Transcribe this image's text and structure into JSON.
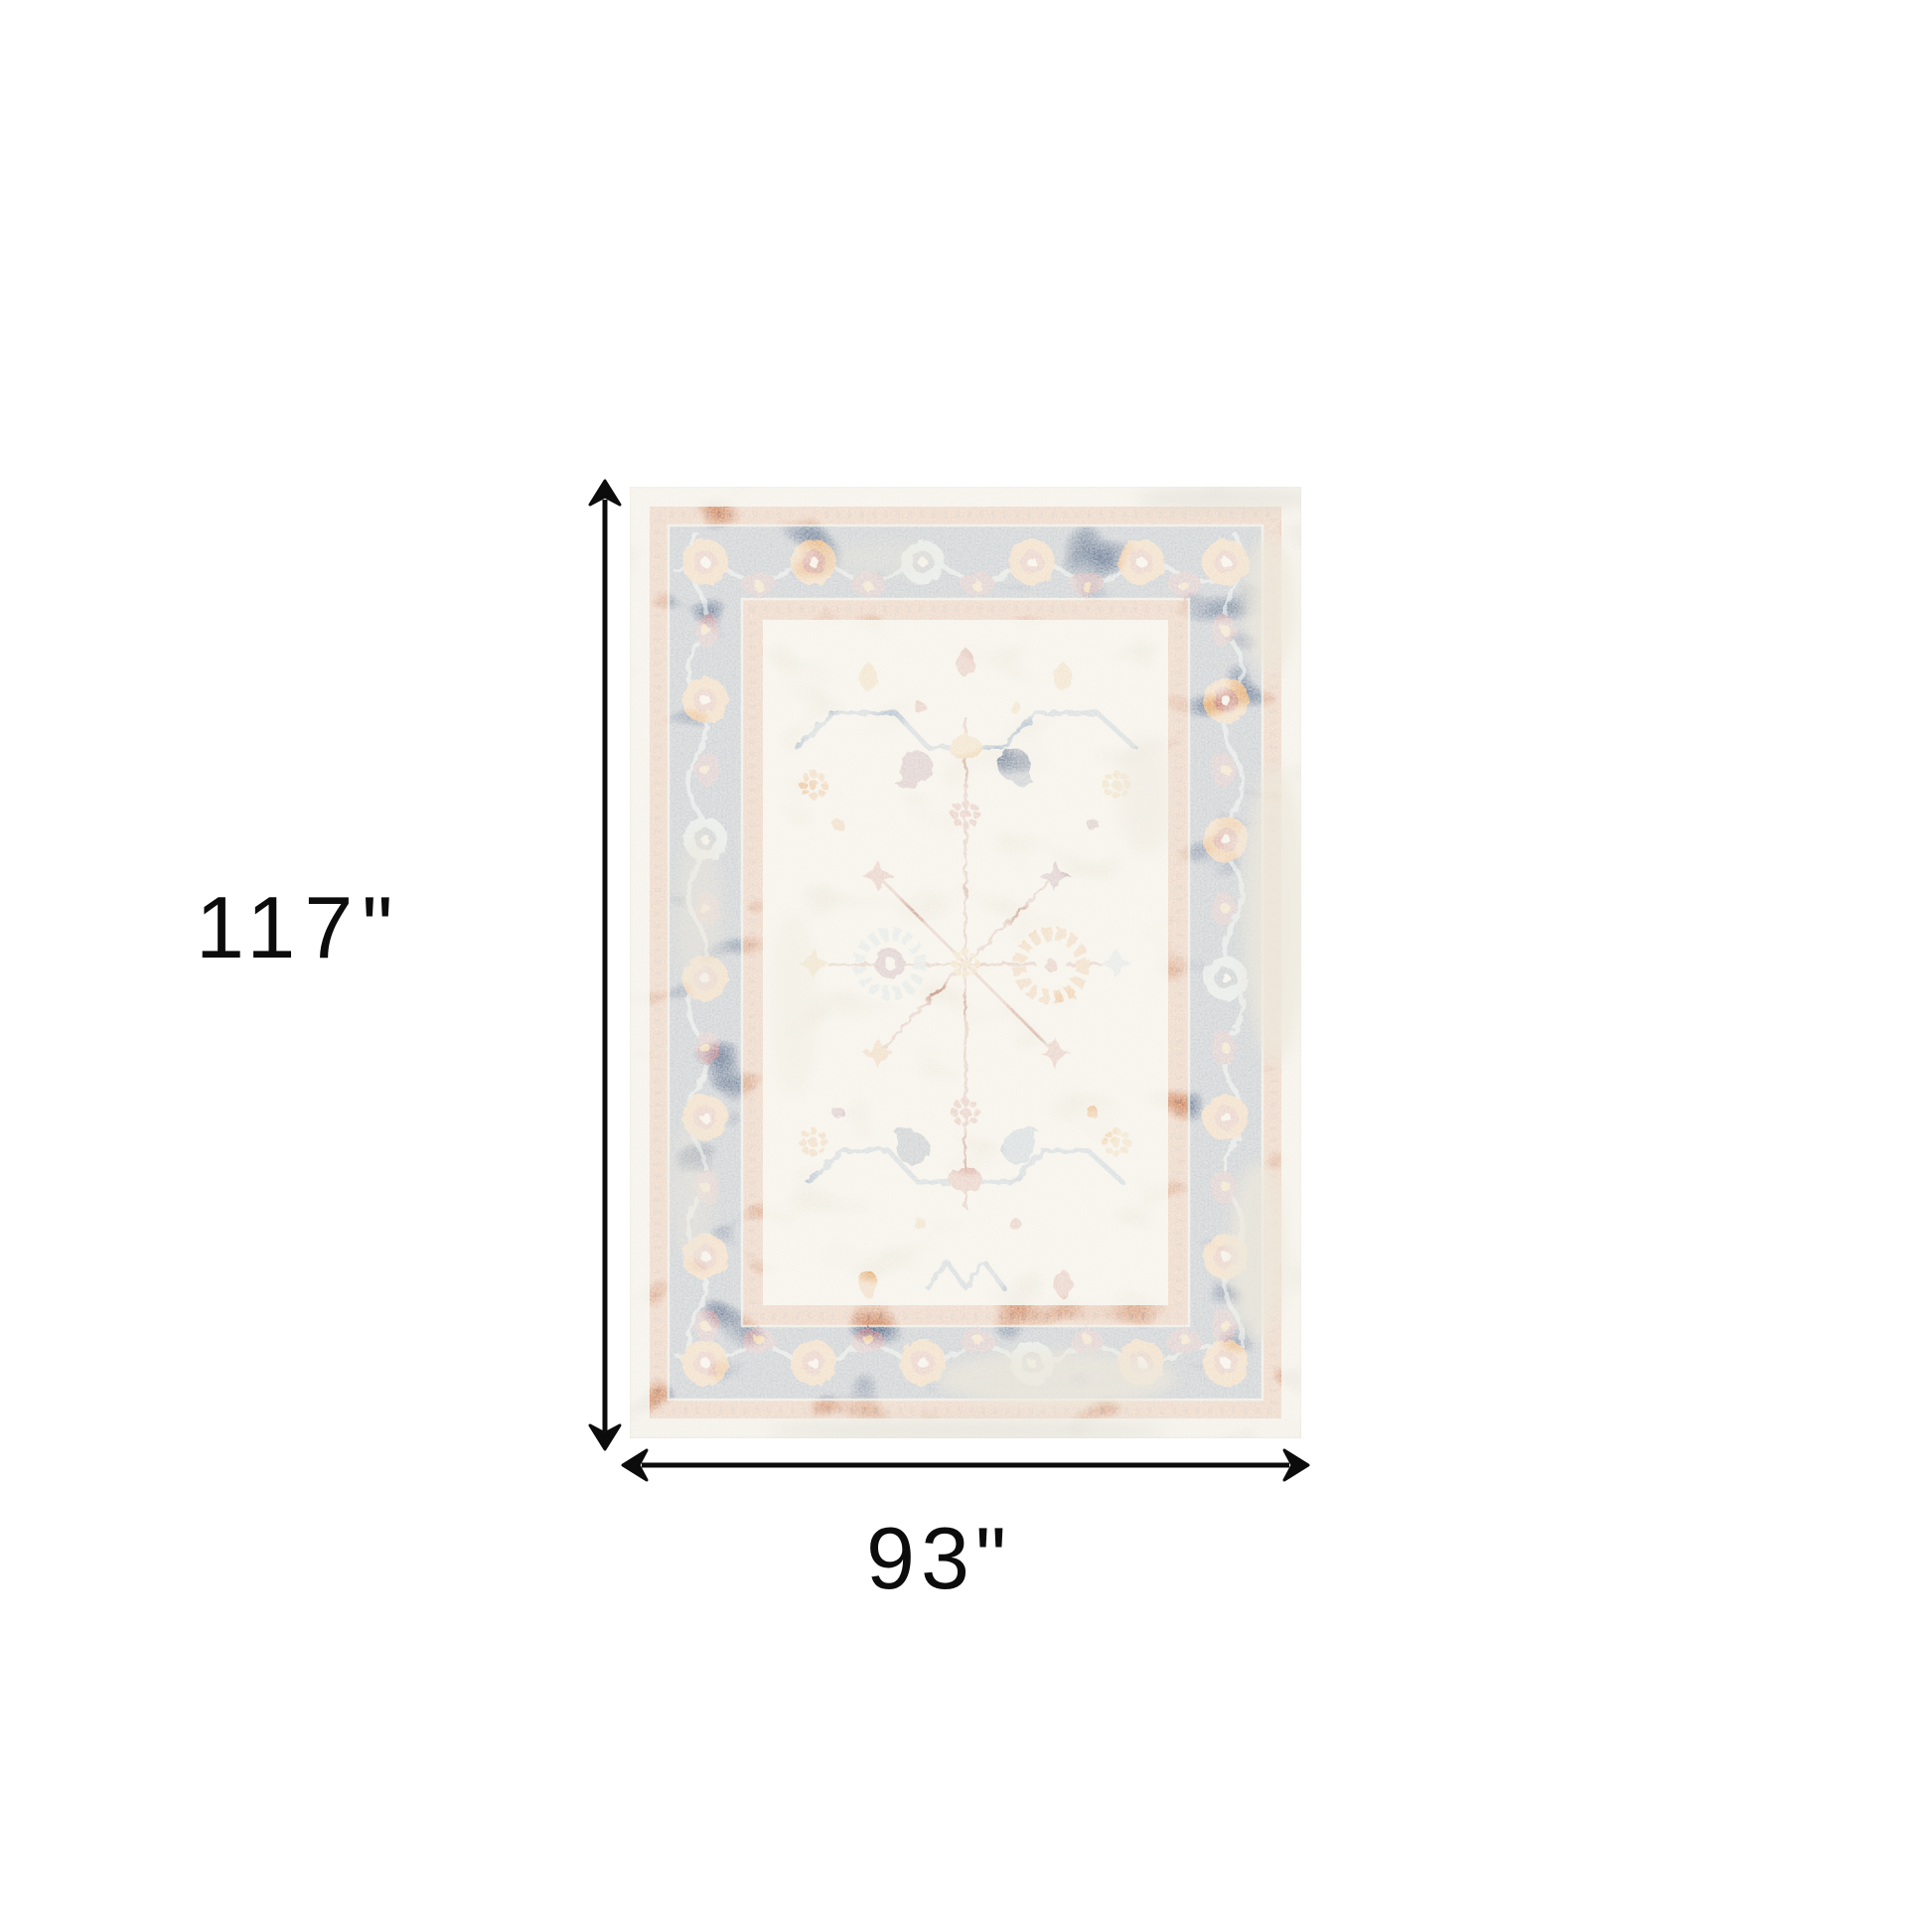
{
  "page": {
    "background_color": "#ffffff"
  },
  "dimension_annotations": {
    "height": {
      "label": "117\""
    },
    "width": {
      "label": "93\""
    },
    "arrow_style": "double-headed chevron arrows",
    "color": "#0c0c0c"
  },
  "rug": {
    "palette": {
      "selvage": "#e7e4da",
      "selvage_dark": "#d6d3c9",
      "guard_rust": "#bf5e2b",
      "guard_rust_dark": "#93421f",
      "border_navy": "#26406b",
      "border_navy_dark": "#1a2c4f",
      "field_ivory": "#ede8dc",
      "accent_orange": "#d9842f",
      "accent_gold": "#dfa348",
      "accent_red": "#b04c38",
      "accent_maroon": "#7d3d54",
      "accent_navy": "#2b3f66",
      "accent_steel": "#5c7fa3",
      "accent_lblue": "#a4c0cf",
      "accent_cream": "#f1ece1",
      "stem": "#a5563e"
    }
  }
}
